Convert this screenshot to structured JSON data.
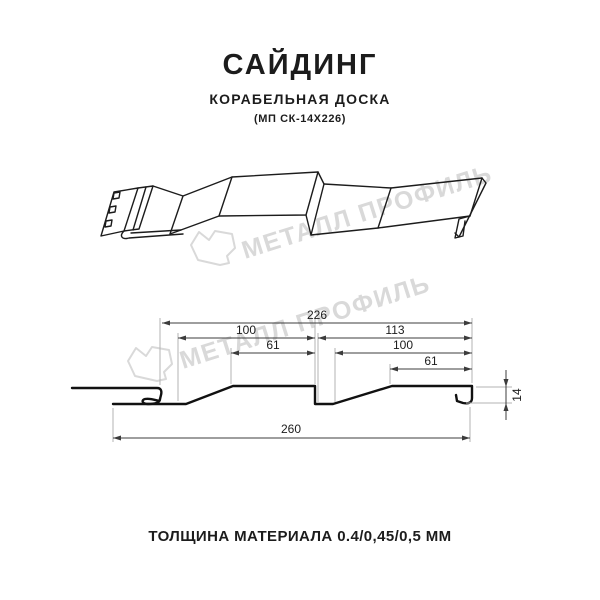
{
  "header": {
    "title": "САЙДИНГ",
    "subtitle": "КОРАБЕЛЬНАЯ ДОСКА",
    "model": "(МП СК-14Х226)"
  },
  "watermark": {
    "text": "МЕТАЛЛ ПРОФИЛЬ",
    "color": "#d9d9d9"
  },
  "section_drawing": {
    "dims": {
      "overall_top": "226",
      "left_board_width": "100",
      "left_flat_width": "61",
      "right_board_width": "113",
      "right_inner_width": "100",
      "right_flat_width": "61",
      "overall_bottom": "260",
      "profile_height": "14"
    }
  },
  "footer": {
    "text": "ТОЛЩИНА МАТЕРИАЛА 0.4/0,45/0,5 ММ"
  },
  "colors": {
    "line": "#1c1c1c",
    "dimension": "#3c3c3c",
    "extension": "#b3b3b3",
    "watermark": "#d9d9d9",
    "background": "#ffffff"
  }
}
